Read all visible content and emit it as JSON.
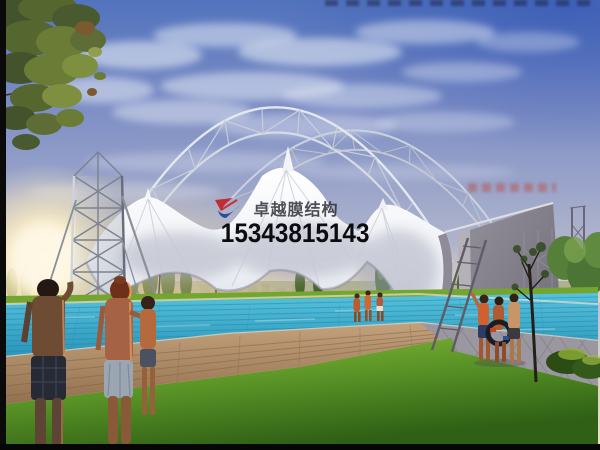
{
  "window": {
    "width": 600,
    "height": 450
  },
  "scene": {
    "subject": "architectural rendering of a white tensile membrane canopy with steel truss arches over an outdoor swimming pool at sunset",
    "elements": [
      "steel-truss-arch",
      "lattice-mast-tower",
      "membrane-canopy",
      "anchor-wall",
      "swimming-pool",
      "paved-walkway",
      "lawn",
      "poplar-treeline",
      "sunset-glow",
      "foreground-people",
      "poolside-people",
      "foreground-tree"
    ]
  },
  "watermark": {
    "brand_text": "卓越膜结构",
    "phone_number": "15343815143",
    "logo_icon": "swoosh-logo",
    "brand_color": "#28282e",
    "phone_color": "#0b0b10",
    "logo_red": "#c41e22",
    "logo_blue": "#1e3f9e"
  },
  "palette": {
    "sky_top_blue": "#5273bd",
    "sky_mid": "#a9b0cc",
    "horizon_warm": "#eadfc0",
    "sun_glow": "#fff8e6",
    "membrane_white": "#f3f5f9",
    "steel_grey": "#dde2ea",
    "wall_grey": "#85828e",
    "pool_water": "#3fa9cc",
    "lawn_bright": "#8ec13c",
    "lawn_dark": "#2f6015",
    "deck_tan": "#b5936e",
    "deck_grey": "#9b97a0",
    "foliage_dark": "#3f5f2c",
    "border_black": "#0a0a0a"
  }
}
